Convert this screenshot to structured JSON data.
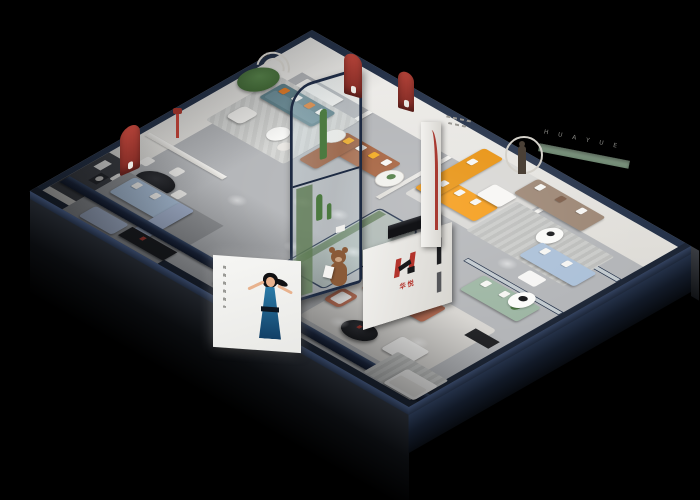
{
  "scene": {
    "description": "Isometric 3D cutaway render of a furniture showroom floor plan on a black background",
    "branding": {
      "logo_glyph": "H",
      "logo_text_cn": "华悦",
      "wall_letters": "H U A Y U E"
    },
    "areas": [
      {
        "name": "dining-area",
        "accent": "#17181a"
      },
      {
        "name": "teal-sofa-lounge",
        "accent": "#5f8089"
      },
      {
        "name": "caramel-sofa-lounge",
        "accent": "#a4603c"
      },
      {
        "name": "orange-sectional-room",
        "accent": "#f59b16"
      },
      {
        "name": "taupe-sofa-lounge",
        "accent": "#9c8674"
      },
      {
        "name": "glass-atrium",
        "accent": "#1d2a42"
      },
      {
        "name": "logo-showroom",
        "accent": "#b56a50"
      },
      {
        "name": "pale-blue-lounge",
        "accent": "#abc0d8"
      },
      {
        "name": "sage-sofa-room",
        "accent": "#9db6a3"
      },
      {
        "name": "front-billboard",
        "accent": "#2a7ba8"
      }
    ]
  },
  "palette": {
    "bg": "#000000",
    "navy": "#26334a",
    "navydark": "#1a2435",
    "wallwhite": "#eceae6",
    "floor": "#b3b5b8",
    "floordark": "#96989b",
    "rug": "#d6d4d0",
    "red": "#a83a31",
    "logored": "#b3342c",
    "orange": "#f59b16",
    "caramel": "#a4603c",
    "teal": "#5f8089",
    "paleblue": "#abc0d8",
    "sage": "#9db6a3",
    "taupe": "#9c8674",
    "terracotta": "#b56a50",
    "yellow": "#f1a91e",
    "tree": "#4c7a40",
    "glassframe": "#1d2a42",
    "dressblue": "#1d5d8f",
    "skin": "#e8b28e",
    "bear": "#8a5a38",
    "black": "#141517",
    "white": "#f4f3f1"
  }
}
